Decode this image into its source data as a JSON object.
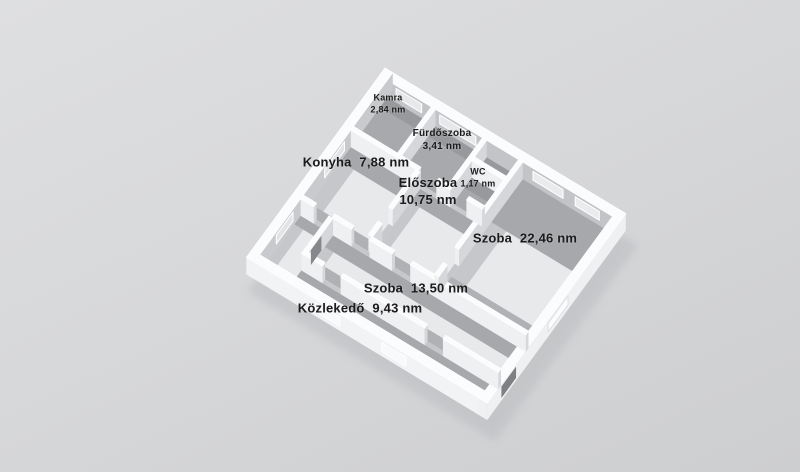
{
  "background": {
    "top": "#dedfe1",
    "bottom": "#cdced0"
  },
  "rooms": [
    {
      "id": "kamra",
      "name": "Kamra",
      "area": "2,84 nm"
    },
    {
      "id": "furdoszoba",
      "name": "Fürdőszoba",
      "area": "3,41 nm"
    },
    {
      "id": "wc",
      "name": "WC",
      "area": "1,17 nm"
    },
    {
      "id": "konyha",
      "name": "Konyha",
      "area": "7,88 nm"
    },
    {
      "id": "eloszoba",
      "name": "Előszoba",
      "area": "10,75 nm"
    },
    {
      "id": "szoba-nagy",
      "name": "Szoba",
      "area": "22,46 nm"
    },
    {
      "id": "szoba-kis",
      "name": "Szoba",
      "area": "13,50 nm"
    },
    {
      "id": "kozlekedo",
      "name": "Közlekedő",
      "area": "9,43 nm"
    }
  ],
  "plan": {
    "view": {
      "ox": 385,
      "oy": 85,
      "ex": [
        0.86,
        0.52
      ],
      "ey": [
        -0.6,
        0.82
      ],
      "scale": 35,
      "wall_px": 17
    },
    "palette": {
      "floor_light": "#e8e9eb",
      "floor_dark": "#a7a9ac",
      "shade_top": "#a6a8ab",
      "shade_dark": "#97999c",
      "shade_bottom": "#afb1b4",
      "shade_left": "#c5c7ca",
      "wall_top": "#fbfcfd",
      "face_y": "#eef0f2",
      "face_x": "#d5d7da",
      "outline": "#ffffff",
      "ground_shadow": "#b8babd"
    },
    "floors": [
      {
        "room": "kamra",
        "r": [
          0.26,
          0.26,
          1.72,
          1.87
        ],
        "tone": "dark"
      },
      {
        "room": "furdoszoba",
        "r": [
          1.86,
          0.26,
          3.42,
          1.87
        ],
        "tone": "dark"
      },
      {
        "room": "closet",
        "r": [
          3.56,
          0.26,
          4.62,
          0.84
        ],
        "tone": "dark"
      },
      {
        "room": "wc",
        "r": [
          3.56,
          0.97,
          4.62,
          1.87
        ],
        "tone": "dark"
      },
      {
        "room": "konyha",
        "r": [
          0.26,
          2.0,
          2.42,
          4.26
        ],
        "tone": "light",
        "tb": 0.5,
        "bb": 0.3,
        "lb": 0.45
      },
      {
        "room": "eloszoba",
        "r": [
          2.56,
          2.0,
          4.62,
          4.26
        ],
        "tone": "light",
        "tb": 0.45,
        "bb": 0.28,
        "lb": 0.3
      },
      {
        "room": "szoba-nagy",
        "r": [
          4.76,
          0.26,
          7.74,
          4.26
        ],
        "tone": "light",
        "tb": 1.5,
        "bb": 0.6,
        "lb": 0.5
      },
      {
        "room": "szoba-kis",
        "r": [
          1.34,
          4.39,
          7.74,
          5.57
        ],
        "tone": "light",
        "tb": 0.4,
        "bb": 0.3,
        "lb": 0.3
      },
      {
        "room": "kozlekedo",
        "r": [
          0.26,
          4.39,
          1.2,
          6.34
        ],
        "tone": "light",
        "tb": 0.3,
        "bb": 0.25,
        "lb": 0.3
      },
      {
        "room": "kozlekedo",
        "r": [
          1.2,
          5.7,
          7.74,
          6.34
        ],
        "tone": "light",
        "tb": 0.33,
        "bb": 0.2,
        "lb": 0
      }
    ],
    "walls": [
      {
        "r": [
          0.0,
          0.0,
          8.0,
          0.26
        ],
        "fy": "#c2c4c7"
      },
      {
        "r": [
          0.0,
          0.0,
          0.26,
          6.6
        ],
        "fx": "#c8cacd"
      },
      {
        "r": [
          0.26,
          1.87,
          2.5,
          2.0
        ]
      },
      {
        "r": [
          3.1,
          1.87,
          3.56,
          2.0
        ]
      },
      {
        "r": [
          4.1,
          1.87,
          4.62,
          2.0
        ]
      },
      {
        "r": [
          1.72,
          0.26,
          1.86,
          1.87
        ]
      },
      {
        "r": [
          3.42,
          0.26,
          3.56,
          1.87
        ]
      },
      {
        "r": [
          3.56,
          0.84,
          4.62,
          0.97
        ]
      },
      {
        "r": [
          4.62,
          0.26,
          4.76,
          3.3
        ]
      },
      {
        "r": [
          4.62,
          3.85,
          4.76,
          4.26
        ]
      },
      {
        "r": [
          2.42,
          2.0,
          2.56,
          3.3
        ]
      },
      {
        "r": [
          2.42,
          3.8,
          2.56,
          4.26
        ]
      },
      {
        "r": [
          0.26,
          4.26,
          0.7,
          4.39
        ]
      },
      {
        "r": [
          1.3,
          4.26,
          1.95,
          4.39
        ]
      },
      {
        "r": [
          2.55,
          4.26,
          3.3,
          4.39
        ]
      },
      {
        "r": [
          3.9,
          4.26,
          7.74,
          4.39
        ]
      },
      {
        "r": [
          1.2,
          4.39,
          1.34,
          5.57
        ]
      },
      {
        "r": [
          1.2,
          5.57,
          1.9,
          5.7
        ]
      },
      {
        "r": [
          2.5,
          5.57,
          5.3,
          5.7
        ]
      },
      {
        "r": [
          5.9,
          5.57,
          7.74,
          5.7
        ]
      },
      {
        "r": [
          7.74,
          0.0,
          8.0,
          6.6
        ],
        "fx": "#eef0f2"
      },
      {
        "r": [
          0.0,
          6.34,
          8.0,
          6.6
        ],
        "fy": "#f2f3f5"
      }
    ],
    "windows": [
      {
        "dir": "x",
        "at": 0.26,
        "a": 0.55,
        "b": 1.4,
        "z": [
          0.3,
          0.82
        ],
        "fill": "#e6e8ea",
        "stroke": "#ffffff"
      },
      {
        "dir": "x",
        "at": 0.26,
        "a": 2.0,
        "b": 3.2,
        "z": [
          0.3,
          0.82
        ],
        "fill": "#e6e8ea",
        "stroke": "#ffffff"
      },
      {
        "dir": "x",
        "at": 0.26,
        "a": 5.1,
        "b": 6.1,
        "z": [
          0.3,
          0.82
        ],
        "fill": "#e9ebed",
        "stroke": "#ffffff"
      },
      {
        "dir": "x",
        "at": 0.26,
        "a": 6.5,
        "b": 7.3,
        "z": [
          0.3,
          0.82
        ],
        "fill": "#e9ebed",
        "stroke": "#ffffff"
      },
      {
        "dir": "y",
        "at": 0.26,
        "a": 2.3,
        "b": 3.25,
        "z": [
          0.3,
          0.82
        ],
        "fill": "#e2e4e6",
        "stroke": "#ffffff"
      },
      {
        "dir": "y",
        "at": 0.26,
        "a": 4.75,
        "b": 5.55,
        "z": [
          0.3,
          0.82
        ],
        "fill": "#e2e4e6",
        "stroke": "#ffffff"
      },
      {
        "dir": "y",
        "at": 8.0,
        "a": 2.75,
        "b": 3.7,
        "z": [
          0.28,
          0.8
        ],
        "fill": "#fbfcfd",
        "stroke": "#dddfe1"
      },
      {
        "dir": "y",
        "at": 8.0,
        "a": 5.2,
        "b": 5.95,
        "z": [
          0.1,
          0.88
        ],
        "fill": "#7e8083",
        "stroke": "#f2f3f5"
      },
      {
        "dir": "x",
        "at": 6.6,
        "a": 2.3,
        "b": 3.1,
        "z": [
          0.28,
          0.8
        ],
        "fill": "#f8f9fb",
        "stroke": "#ffffff"
      },
      {
        "dir": "x",
        "at": 6.6,
        "a": 4.5,
        "b": 5.3,
        "z": [
          0.28,
          0.8
        ],
        "fill": "#f8f9fb",
        "stroke": "#ffffff"
      },
      {
        "dir": "y",
        "at": 1.34,
        "a": 4.95,
        "b": 5.45,
        "z": [
          0.05,
          0.92
        ],
        "fill": "#85878a",
        "stroke": "none"
      }
    ]
  }
}
